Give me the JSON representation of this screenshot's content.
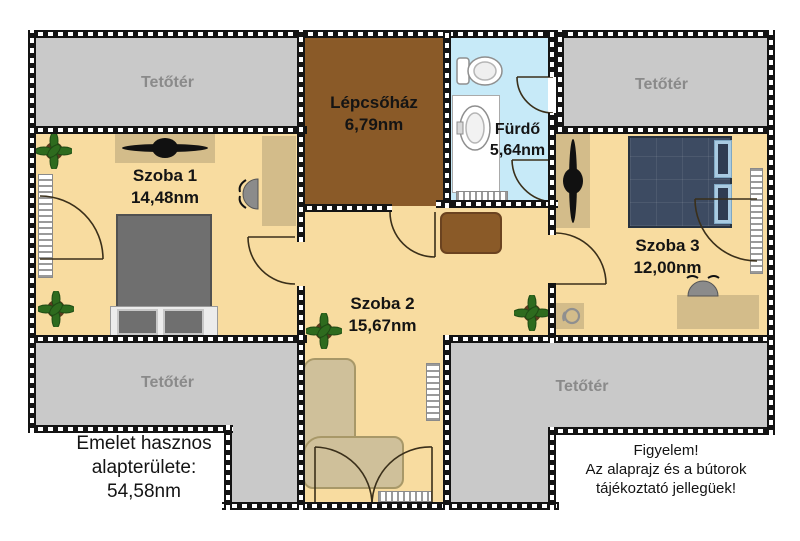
{
  "floorplan": {
    "attics": {
      "top_left": "Tetőtér",
      "top_right": "Tetőtér",
      "bottom_left": "Tetőtér",
      "bottom_right": "Tetőtér"
    },
    "staircase": {
      "name": "Lépcsőház",
      "area": "6,79nm"
    },
    "bathroom": {
      "name": "Fürdő",
      "area": "5,64nm"
    },
    "room1": {
      "name": "Szoba 1",
      "area": "14,48nm"
    },
    "room2": {
      "name": "Szoba 2",
      "area": "15,67nm"
    },
    "room3": {
      "name": "Szoba 3",
      "area": "12,00nm"
    },
    "summary": {
      "line1": "Emelet hasznos",
      "line2": "alapterülete:",
      "line3": "54,58nm"
    },
    "disclaimer": {
      "line1": "Figyelem!",
      "line2": "Az alaprajz és a bútorok",
      "line3": "tájékoztató jellegüek!"
    },
    "colors": {
      "room_fill": "#f8dca0",
      "attic_fill": "#c9c9c9",
      "staircase_fill": "#8a5a28",
      "bathroom_fill": "#c7eaf8",
      "furniture_tan": "#d3bc8a",
      "bed_gray": "#6f6f6f",
      "bed_navy": "#3d4b62",
      "pillow_blue": "#a9cbe2",
      "sofa_beige": "#cfc09a",
      "plant_green": "#2e6b1e",
      "attic_text": "#8a8a8a",
      "wall": "#141414"
    }
  }
}
